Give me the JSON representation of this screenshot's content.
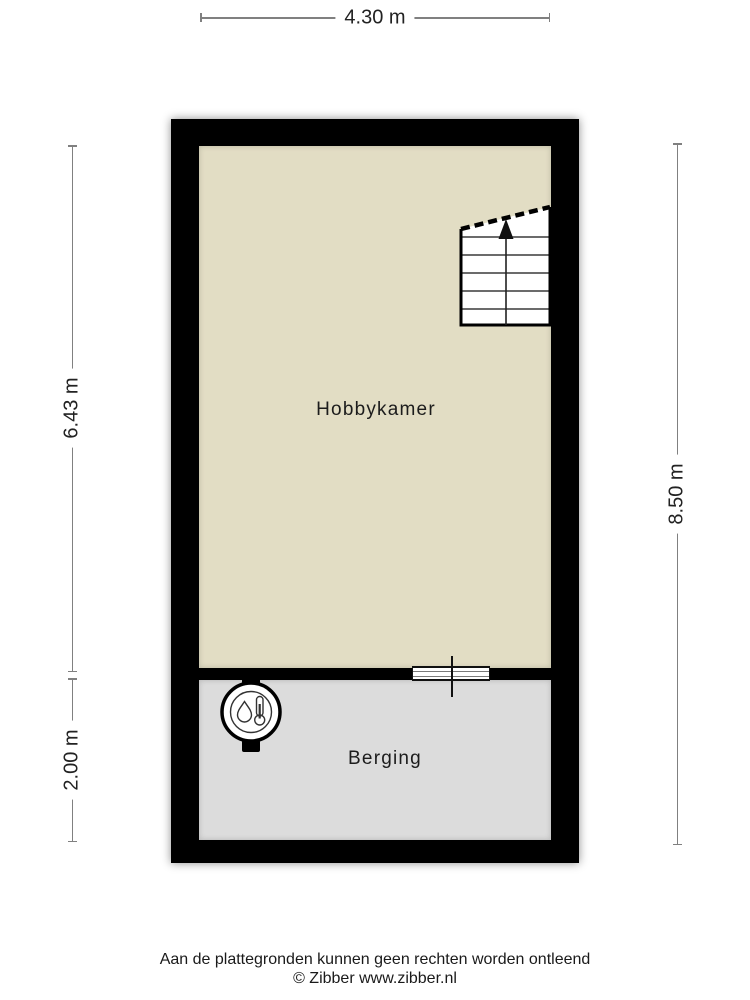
{
  "floorplan": {
    "rooms": [
      {
        "name": "Hobbykamer",
        "floor_color": "#e2ddc4"
      },
      {
        "name": "Berging",
        "floor_color": "#dcdcdc"
      }
    ],
    "wall_color": "#000000",
    "stairs": {
      "direction": "up"
    },
    "icons": {
      "stairs": "stairs-up-icon",
      "boiler": "boiler-icon",
      "window": "interior-window-icon"
    }
  },
  "dimensions": {
    "top_width": {
      "label": "4.30 m"
    },
    "left_upper_height": {
      "label": "6.43 m"
    },
    "left_lower_height": {
      "label": "2.00 m"
    },
    "right_total_height": {
      "label": "8.50 m"
    }
  },
  "footer": {
    "disclaimer": "Aan de plattegronden kunnen geen rechten worden ontleend",
    "copyright": "© Zibber www.zibber.nl"
  },
  "colors": {
    "dimension_line": "#808080",
    "text": "#1f1f1f",
    "page_background": "#ffffff"
  }
}
